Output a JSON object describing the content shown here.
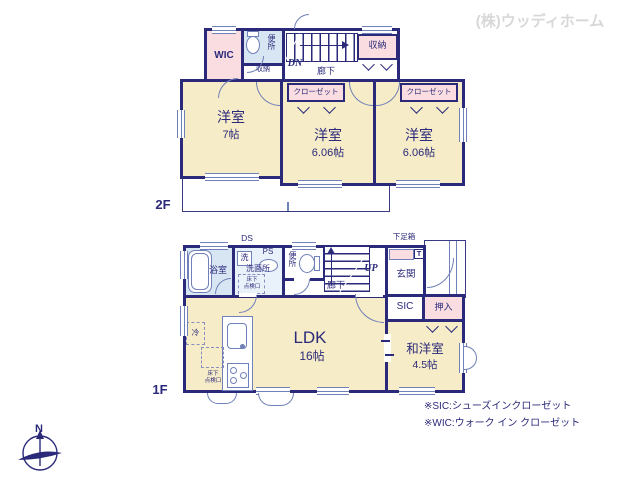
{
  "company": "(株)ウッディホーム",
  "floor2": {
    "label": "2F",
    "wic": "WIC",
    "storage_niche": "収納",
    "toilet": "便所",
    "dn": "DN",
    "hallway": "廊下",
    "storage": "収納",
    "closet_left": "クローゼット",
    "closet_right": "クローゼット",
    "room_west": {
      "name": "洋室",
      "size": "7帖"
    },
    "room_center": {
      "name": "洋室",
      "size": "6.06帖"
    },
    "room_east": {
      "name": "洋室",
      "size": "6.06帖"
    }
  },
  "floor1": {
    "label": "1F",
    "ds": "DS",
    "bath": "浴室",
    "washer": "洗",
    "ps": "PS",
    "washroom": "洗面所",
    "hatch_small_l1": "床下",
    "hatch_small_l2": "点検口",
    "toilet": "便所",
    "up": "UP",
    "hallway": "廊下",
    "shoe_box": "下足箱",
    "t": "T",
    "entrance": "玄関",
    "sic": "SIC",
    "oshiire": "押入",
    "ldk": {
      "name": "LDK",
      "size": "16帖"
    },
    "washitsu": {
      "name": "和洋室",
      "size": "4.5帖"
    },
    "fridge": "冷",
    "hatch_l1": "床下",
    "hatch_l2": "点検口"
  },
  "notes": {
    "sic": "※SIC:シューズインクローゼット",
    "wic": "※WIC:ウォーク イン クローゼット"
  },
  "compass": {
    "n": "N"
  }
}
